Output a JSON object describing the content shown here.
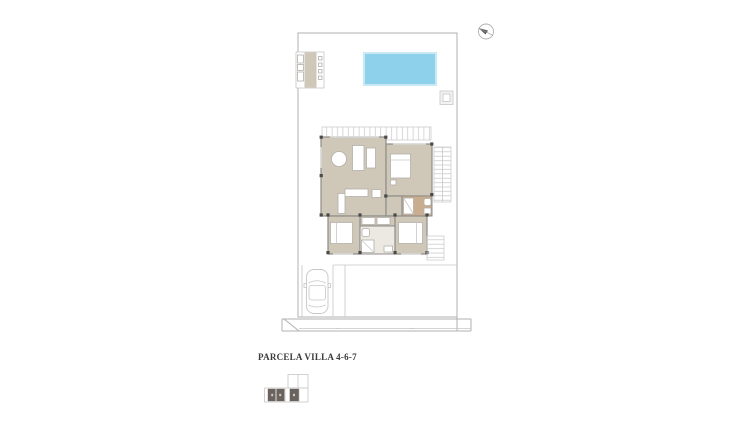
{
  "page": {
    "background": "#ffffff"
  },
  "plan": {
    "title": "PARCELA VILLA 4-6-7"
  },
  "icons": {
    "compass": "compass-icon (circle with dark needle, top-right of sheet)"
  },
  "colors": {
    "floor": "#cfc7b7",
    "floor_dark": "#c8ae8f",
    "floor_bath": "#ece9e3",
    "pool": "#8ed1ea",
    "pool_border": "#c9e9f5",
    "wall": "#8f8d8a",
    "line_light": "#c7c7c7",
    "line_mid": "#b0b0b0",
    "furn_stroke": "#b3b0ab",
    "column": "#4a4a4a",
    "window": "#dadada",
    "highlight": "#6a635d",
    "text": "#3b3b3b"
  }
}
